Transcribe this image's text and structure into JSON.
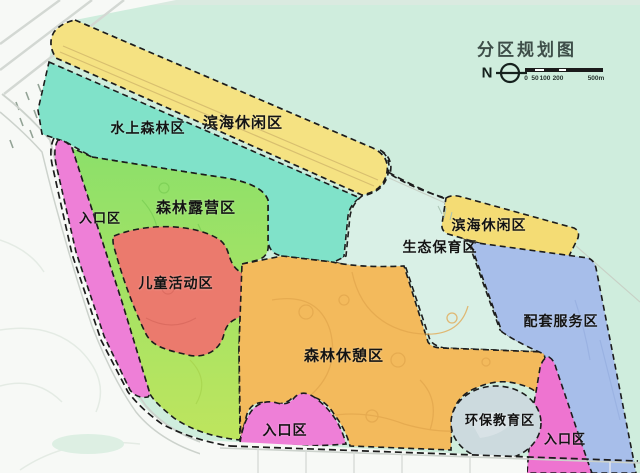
{
  "legend": {
    "title": "分区规划图",
    "north": "N",
    "scale_ticks": [
      "0",
      "50",
      "100",
      "200"
    ],
    "scale_end": "500m"
  },
  "background": {
    "water": "#CFEDDD",
    "land": "#F7F9F6",
    "top_strip": "#DCE9E0",
    "boundary_color": "#1C1C1C",
    "road_color": "#CCD2CC"
  },
  "regions": [
    {
      "key": "coastal-leisure-top",
      "label": "滨海休闲区",
      "color": "#F5E282"
    },
    {
      "key": "water-forest",
      "label": "水上森林区",
      "color": "#80E2C9"
    },
    {
      "key": "forest-camping",
      "label": "森林露营区",
      "color": "#8CE06A",
      "color2": "#BEE55E"
    },
    {
      "key": "entrance-left",
      "label": "入口区",
      "color": "#EE7FD7"
    },
    {
      "key": "children-activity",
      "label": "儿童活动区",
      "color": "#EB7A6D"
    },
    {
      "key": "eco-conservation",
      "label": "生态保育区",
      "color": "#D9F0E6"
    },
    {
      "key": "coastal-leisure-right",
      "label": "滨海休闲区",
      "color": "#F4DC74"
    },
    {
      "key": "forest-rest",
      "label": "森林休憩区",
      "color": "#F3BA5C"
    },
    {
      "key": "support-services",
      "label": "配套服务区",
      "color": "#A7BEEA"
    },
    {
      "key": "eco-education",
      "label": "环保教育区",
      "color": "#CCDADE"
    },
    {
      "key": "entrance-bottom",
      "label": "入口区",
      "color": "#EE7FD7"
    },
    {
      "key": "entrance-right",
      "label": "入口区",
      "color": "#EE74D0"
    }
  ]
}
